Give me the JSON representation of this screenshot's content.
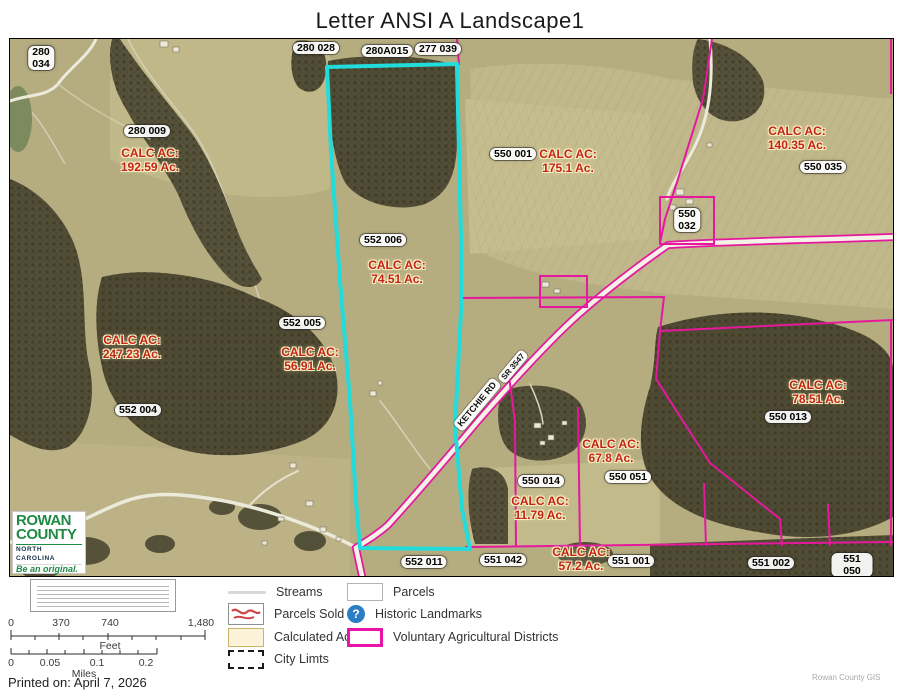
{
  "title": "Letter ANSI A Landscape1",
  "printed_on": "Printed on: April 7, 2026",
  "attribution": "Rowan County GIS",
  "map": {
    "calc_prefix": "CALC AC:",
    "road": {
      "name": "KETCHIE RD",
      "number": "SR 3547"
    },
    "parcels": {
      "p280_034": "280\n034",
      "p280_028": "280 028",
      "p280A015": "280A015",
      "p277_039": "277 039",
      "p280_009": "280 009",
      "p550_001": "550 001",
      "p550_035": "550 035",
      "p550_032": "550\n032",
      "p552_006": "552 006",
      "p552_005": "552 005",
      "p552_004": "552 004",
      "p550_013": "550 013",
      "p550_014": "550 014",
      "p550_051": "550 051",
      "p552_011": "552 011",
      "p551_042": "551 042",
      "p551_001": "551 001",
      "p551_002": "551 002",
      "p551_050": "551 050"
    },
    "calc_acres": {
      "c280_009": "192.59 Ac.",
      "c550_001": "175.1 Ac.",
      "c550_035": "140.35 Ac.",
      "c552_006": "74.51 Ac.",
      "c247": "247.23 Ac.",
      "c552_005": "56.91 Ac.",
      "c550_013": "78.51 Ac.",
      "c550_051": "67.8 Ac.",
      "c550_014": "11.79 Ac.",
      "c551": "57.2 Ac."
    },
    "logo": {
      "line1": "ROWAN",
      "line2": "COUNTY",
      "line3": "NORTH CAROLINA",
      "tagline": "Be an original."
    }
  },
  "legend": {
    "streams": "Streams",
    "parcels": "Parcels",
    "parcels_sold": "Parcels Sold",
    "historic": "Historic Landmarks",
    "historic_icon": "?",
    "calculated": "Calculated Ac",
    "vad": "Voluntary Agricultural Districts",
    "city": "City Limts"
  },
  "scalebar": {
    "feet": {
      "t0": "0",
      "t1": "370",
      "t2": "740",
      "t3": "1,480",
      "unit": "Feet"
    },
    "miles": {
      "t0": "0",
      "t1": "0.05",
      "t2": "0.1",
      "t3": "0.2",
      "unit": "Miles"
    }
  },
  "colors": {
    "highlight_cyan": "#22DCDC",
    "vad_magenta": "#E6189E",
    "calc_text": "#C3231B",
    "logo_green": "#1E8A44"
  }
}
